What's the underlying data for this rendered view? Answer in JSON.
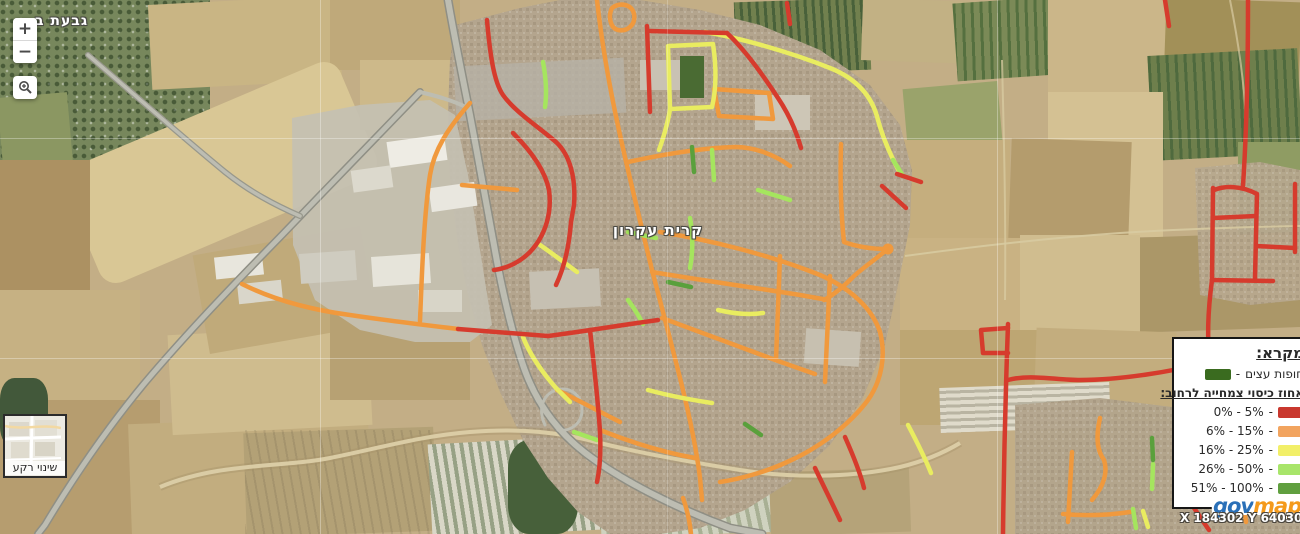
{
  "app": {
    "name": "govmap"
  },
  "map": {
    "city_label": "קרית עקרון",
    "corner_label": "גבעת ב",
    "coordinates": "X 184302 Y 640303"
  },
  "controls": {
    "zoom_in_label": "+",
    "zoom_out_label": "−",
    "basemap_button_label": "שינוי רקע"
  },
  "legend": {
    "title": "מקרא:",
    "tree_canopy_label": "חופות עצים",
    "tree_canopy_color": "#3a6b1f",
    "subtitle": "אחוז כיסוי צמחייה לרחוב:",
    "separator": "-",
    "entries": [
      {
        "label": "0% - 5%",
        "color": "#c9382e"
      },
      {
        "label": "6% - 15%",
        "color": "#f2a45f"
      },
      {
        "label": "16% - 25%",
        "color": "#f2ef68"
      },
      {
        "label": "26% - 50%",
        "color": "#a8e56a"
      },
      {
        "label": "51% - 100%",
        "color": "#609f3f"
      }
    ]
  },
  "logo": {
    "part1": "gov",
    "part2": "map",
    "part1_color": "#2a70b8",
    "part2_color": "#f49a1c"
  },
  "street_colors": {
    "red": "#d63b2d",
    "orange": "#f0993d",
    "yellow": "#e9ec60",
    "light_green": "#a5e55e",
    "green": "#5aa03c"
  }
}
